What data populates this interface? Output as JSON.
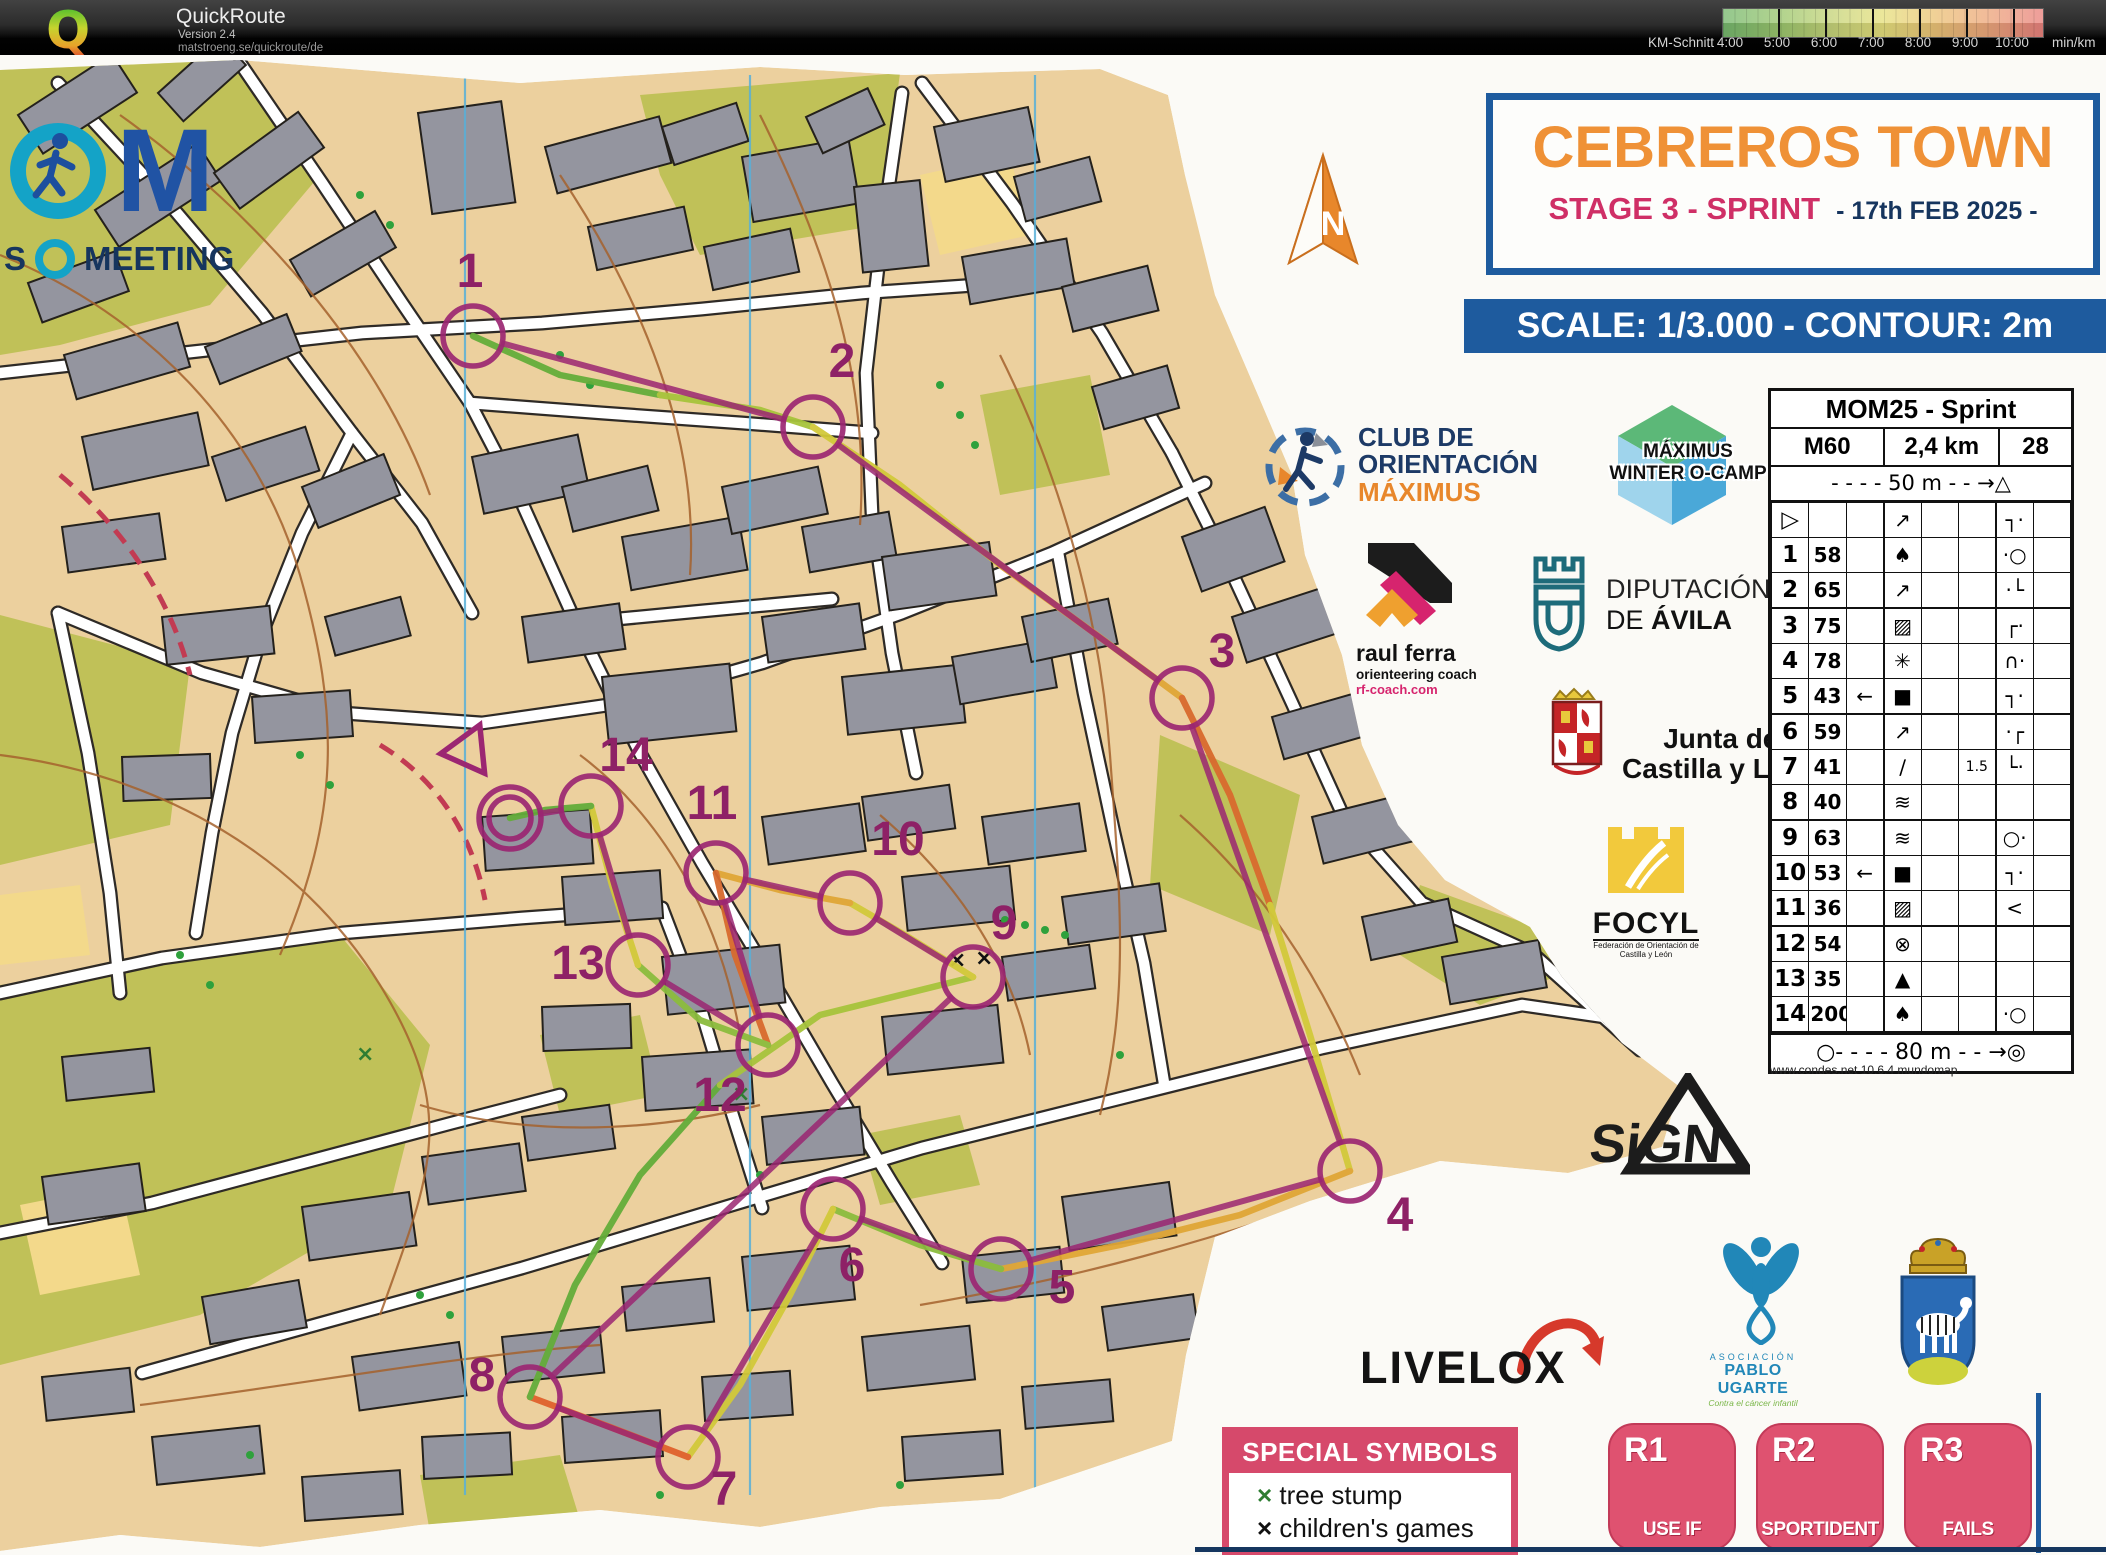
{
  "header": {
    "app_name": "QuickRoute",
    "version": "Version 2.4",
    "url": "matstroeng.se/quickroute/de",
    "legend": {
      "label": "KM-Schnitt",
      "ticks": [
        "4:00",
        "5:00",
        "6:00",
        "7:00",
        "8:00",
        "9:00",
        "10:00"
      ],
      "unit": "min/km",
      "colors": [
        "#76b86e",
        "#9cc76e",
        "#c6d47a",
        "#e6e07e",
        "#ecc478",
        "#eda97c",
        "#e9827e"
      ]
    }
  },
  "event_logo": {
    "big": "M",
    "sub_left": "S",
    "sub_right": "MEETING"
  },
  "north_label": "N",
  "title_box": {
    "title": "CEBREROS TOWN",
    "stage": "STAGE 3 - SPRINT",
    "date": "- 17th FEB 2025 -"
  },
  "scale_banner": "SCALE: 1/3.000 - CONTOUR: 2m",
  "sponsors": {
    "club": {
      "line1": "CLUB DE",
      "line2": "ORIENTACIÓN",
      "line3": "MÁXIMUS"
    },
    "ocamp": {
      "line1": "MÁXIMUS",
      "line2": "WINTER O-CAMP"
    },
    "raul": {
      "name": "raul ferra",
      "role": "orienteering coach",
      "url": "rf-coach.com"
    },
    "diputacion": {
      "line1": "DIPUTACIÓN",
      "line2": "DE ",
      "line2b": "ÁVILA"
    },
    "junta": {
      "line1": "Junta de",
      "line2": "Castilla y León"
    },
    "focyl": {
      "name": "FOCYL",
      "sub1": "Federación de Orientación de",
      "sub2": "Castilla y León"
    },
    "sign": {
      "name": "SiGN"
    },
    "livelox": {
      "name": "LIVELOX"
    },
    "pablo": {
      "line1": "ASOCIACIÓN",
      "line2": "PABLO UGARTE",
      "line3": "Contra el cáncer infantil"
    }
  },
  "control_sheet": {
    "title": "MOM25 - Sprint",
    "course_class": "M60",
    "distance": "2,4 km",
    "climb": "28",
    "start_distance": "- - - -  50 m  - - →△",
    "rows": [
      {
        "n": "▷",
        "code": "",
        "c": "",
        "d": "↗",
        "e": "",
        "f": "",
        "g": "┐·",
        "h": ""
      },
      {
        "n": "1",
        "code": "58",
        "c": "",
        "d": "♠",
        "e": "",
        "f": "",
        "g": "·○",
        "h": ""
      },
      {
        "n": "2",
        "code": "65",
        "c": "",
        "d": "↗",
        "e": "",
        "f": "",
        "g": "·└",
        "h": ""
      },
      {
        "n": "3",
        "code": "75",
        "c": "",
        "d": "▨",
        "e": "",
        "f": "",
        "g": "┌·",
        "h": ""
      },
      {
        "n": "4",
        "code": "78",
        "c": "",
        "d": "✳",
        "e": "",
        "f": "",
        "g": "∩·",
        "h": ""
      },
      {
        "n": "5",
        "code": "43",
        "c": "←",
        "d": "■",
        "e": "",
        "f": "",
        "g": "┐·",
        "h": ""
      },
      {
        "n": "6",
        "code": "59",
        "c": "",
        "d": "↗",
        "e": "",
        "f": "",
        "g": "·┌",
        "h": ""
      },
      {
        "n": "7",
        "code": "41",
        "c": "",
        "d": "∕",
        "e": "",
        "f": "1.5",
        "g": "└·",
        "h": ""
      },
      {
        "n": "8",
        "code": "40",
        "c": "",
        "d": "≋",
        "e": "",
        "f": "",
        "g": "",
        "h": ""
      },
      {
        "n": "9",
        "code": "63",
        "c": "",
        "d": "≋",
        "e": "",
        "f": "",
        "g": "○·",
        "h": ""
      },
      {
        "n": "10",
        "code": "53",
        "c": "←",
        "d": "■",
        "e": "",
        "f": "",
        "g": "┐·",
        "h": ""
      },
      {
        "n": "11",
        "code": "36",
        "c": "",
        "d": "▨",
        "e": "",
        "f": "",
        "g": "<",
        "h": ""
      },
      {
        "n": "12",
        "code": "54",
        "c": "",
        "d": "⊗",
        "e": "",
        "f": "",
        "g": "",
        "h": ""
      },
      {
        "n": "13",
        "code": "35",
        "c": "",
        "d": "▲",
        "e": "",
        "f": "",
        "g": "",
        "h": ""
      },
      {
        "n": "14",
        "code": "200",
        "c": "",
        "d": "♠",
        "e": "",
        "f": "",
        "g": "·○",
        "h": ""
      }
    ],
    "finish_distance": "○- - - -  80 m  - - →◎",
    "credit": "www.condes.net 10.6.4 mundomap"
  },
  "special_symbols": {
    "title": "SPECIAL SYMBOLS",
    "items": [
      {
        "mark": "×",
        "color": "#2e7d32",
        "label": "tree stump"
      },
      {
        "mark": "×",
        "color": "#111111",
        "label": "children's games"
      }
    ]
  },
  "relay_boxes": [
    {
      "code": "R1",
      "label": "USE IF"
    },
    {
      "code": "R2",
      "label": "SPORTIDENT"
    },
    {
      "code": "R3",
      "label": "FAILS"
    }
  ],
  "course": {
    "color": "#9b2672",
    "controls": [
      {
        "label": "1",
        "x": 473,
        "y": 281,
        "nx": 470,
        "ny": 232
      },
      {
        "label": "2",
        "x": 813,
        "y": 372,
        "nx": 842,
        "ny": 322
      },
      {
        "label": "3",
        "x": 1182,
        "y": 643,
        "nx": 1222,
        "ny": 612
      },
      {
        "label": "4",
        "x": 1350,
        "y": 1116,
        "nx": 1400,
        "ny": 1176
      },
      {
        "label": "5",
        "x": 1001,
        "y": 1214,
        "nx": 1062,
        "ny": 1248
      },
      {
        "label": "6",
        "x": 833,
        "y": 1154,
        "nx": 852,
        "ny": 1226
      },
      {
        "label": "7",
        "x": 688,
        "y": 1402,
        "nx": 724,
        "ny": 1450
      },
      {
        "label": "8",
        "x": 530,
        "y": 1342,
        "nx": 482,
        "ny": 1336
      },
      {
        "label": "9",
        "x": 973,
        "y": 922,
        "nx": 1004,
        "ny": 884
      },
      {
        "label": "10",
        "x": 850,
        "y": 848,
        "nx": 898,
        "ny": 800
      },
      {
        "label": "11",
        "x": 716,
        "y": 818,
        "nx": 712,
        "ny": 764
      },
      {
        "label": "12",
        "x": 768,
        "y": 990,
        "nx": 720,
        "ny": 1056
      },
      {
        "label": "13",
        "x": 638,
        "y": 910,
        "nx": 578,
        "ny": 924
      },
      {
        "label": "14",
        "x": 591,
        "y": 751,
        "nx": 626,
        "ny": 716
      }
    ]
  }
}
